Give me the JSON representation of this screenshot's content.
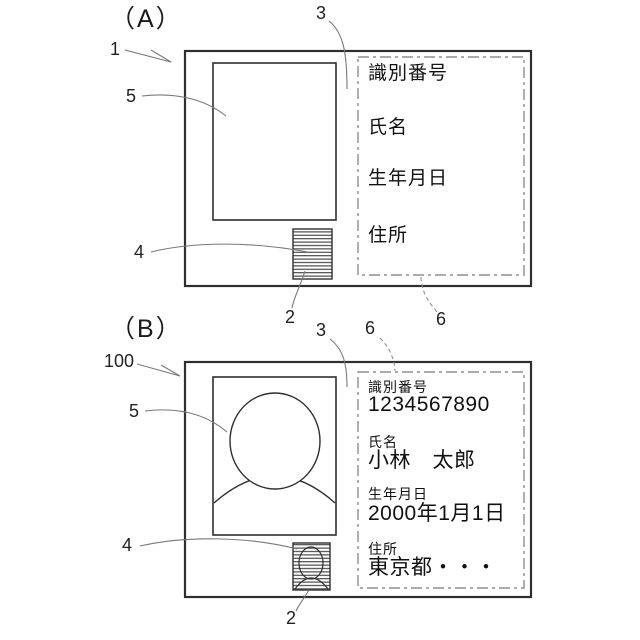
{
  "figure_a": {
    "label": "（A）",
    "ref_card": "1",
    "ref_photo": "5",
    "ref_stamp_region": "4",
    "ref_stamp": "2",
    "ref_print_area": "3",
    "ref_print_border": "6",
    "fields": [
      {
        "label": "識別番号"
      },
      {
        "label": "氏名"
      },
      {
        "label": "生年月日"
      },
      {
        "label": "住所"
      }
    ]
  },
  "figure_b": {
    "label": "（B）",
    "ref_card": "100",
    "ref_photo": "5",
    "ref_stamp_region": "4",
    "ref_stamp": "2",
    "ref_print_area": "3",
    "ref_print_border": "6",
    "fields": [
      {
        "label": "識別番号",
        "value": "1234567890"
      },
      {
        "label": "氏名",
        "value": "小林　太郎"
      },
      {
        "label": "生年月日",
        "value": "2000年1月1日"
      },
      {
        "label": "住所",
        "value": "東京都・・・"
      }
    ]
  },
  "colors": {
    "outline": "#2f2f2f",
    "dashed_border": "#8f8f8f",
    "leader_line": "#787878",
    "background": "#ffffff"
  }
}
